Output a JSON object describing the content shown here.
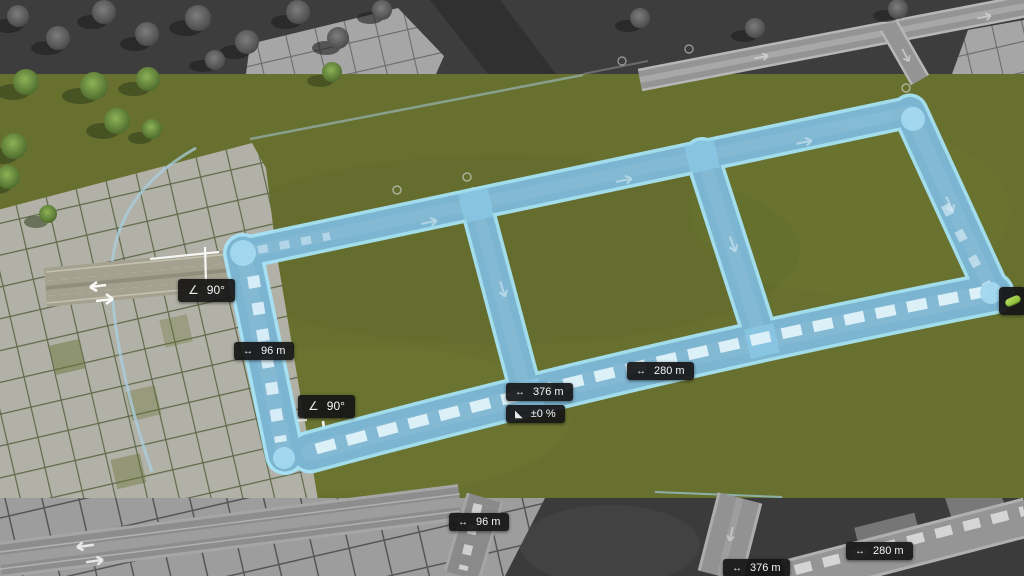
{
  "tool": {
    "name": "road-placement-tool",
    "measurements": {
      "a90top": {
        "icon": "angle-icon",
        "glyph": "∠",
        "value": "90°"
      },
      "w96": {
        "icon": "length-arrow-icon",
        "glyph": "↔",
        "value": "96 m"
      },
      "a90bot": {
        "icon": "angle-icon",
        "glyph": "∠",
        "value": "90°"
      },
      "d376": {
        "icon": "length-arrow-icon",
        "glyph": "↔",
        "value": "376 m"
      },
      "s0": {
        "icon": "slope-icon",
        "glyph": "◣",
        "value": "±0 %"
      },
      "d280": {
        "icon": "length-arrow-icon",
        "glyph": "↔",
        "value": "280 m"
      },
      "w96b": {
        "icon": "length-arrow-icon",
        "glyph": "↔",
        "value": "96 m"
      },
      "d280b": {
        "icon": "length-arrow-icon",
        "glyph": "↔",
        "value": "280 m"
      },
      "d376b": {
        "icon": "length-arrow-icon",
        "glyph": "↔",
        "value": "376 m"
      }
    },
    "cursor": {
      "icon": "money-pill-icon"
    }
  },
  "colors": {
    "grass": "#67702f",
    "road_highlight_fill": "#79b2cf",
    "road_highlight_edge": "#a7e3f7",
    "dash_white": "#dff2f9",
    "label_bg": "#161616",
    "label_text": "#f5f5f5",
    "money_green": "#8fc63f",
    "inactive_gray": "#3d3d3d"
  }
}
